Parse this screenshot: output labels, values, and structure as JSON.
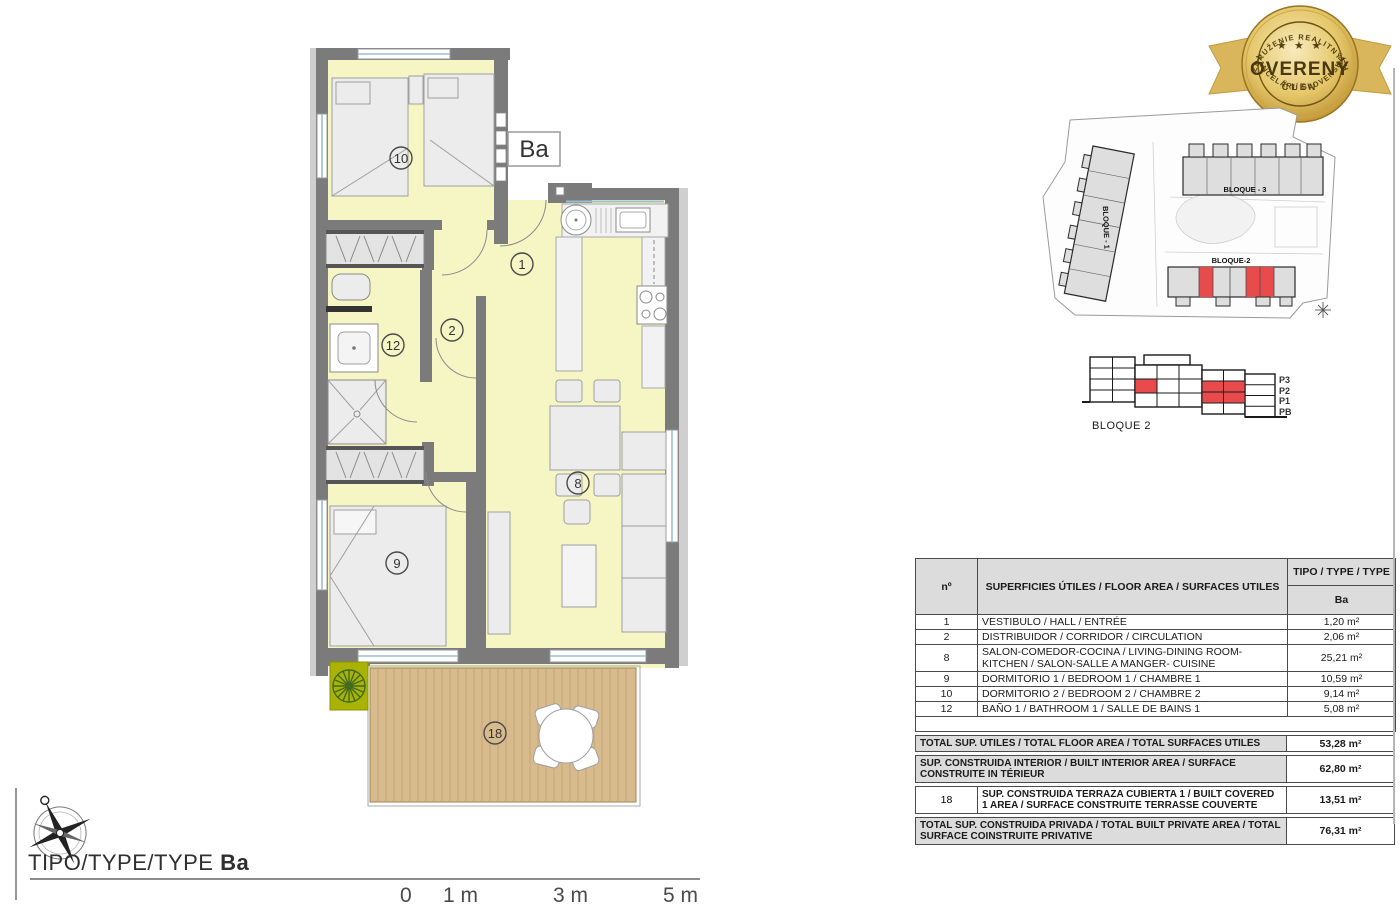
{
  "floor_plan": {
    "type_label": "Ba",
    "rooms": {
      "hall": "1",
      "corridor": "2",
      "living": "8",
      "bedroom1": "9",
      "bedroom2": "10",
      "bathroom": "12",
      "terrace": "18"
    }
  },
  "badge": {
    "arc_top": "ZDRUŽENIE REALITNÝCH",
    "stars": "★ ★ ★",
    "center": "OVERENÝ",
    "subtitle": "ČLEN",
    "arc_bottom": "KANCELÁRIÍ SLOVENSKA",
    "gold_color": "#c7992f"
  },
  "site_plan": {
    "bloque1_label": "BLOQUE - 1",
    "bloque2_label": "BLOQUE-2",
    "bloque3_label": "BLOQUE - 3",
    "highlight_color": "#e94b4d"
  },
  "elevation": {
    "title": "BLOQUE 2",
    "floors": [
      "P3",
      "P2",
      "P1",
      "PB"
    ],
    "highlight_color": "#e94b4d"
  },
  "areas_table": {
    "header": {
      "col_num": "nº",
      "col_desc": "SUPERFICIES ÚTILES / FLOOR AREA / SURFACES UTILES",
      "col_type": "TIPO / TYPE / TYPE",
      "type_value": "Ba"
    },
    "rows": [
      {
        "num": "1",
        "desc": "VESTIBULO / HALL / ENTRÉE",
        "area": "1,20 m²"
      },
      {
        "num": "2",
        "desc": "DISTRIBUIDOR / CORRIDOR / CIRCULATION",
        "area": "2,06 m²"
      },
      {
        "num": "8",
        "desc": "SALON-COMEDOR-COCINA / LIVING-DINING ROOM- KITCHEN / SALON-SALLE A MANGER- CUISINE",
        "area": "25,21 m²"
      },
      {
        "num": "9",
        "desc": "DORMITORIO 1 / BEDROOM 1 / CHAMBRE 1",
        "area": "10,59 m²"
      },
      {
        "num": "10",
        "desc": "DORMITORIO 2 / BEDROOM 2 / CHAMBRE 2",
        "area": "9,14 m²"
      },
      {
        "num": "12",
        "desc": "BAÑO 1 / BATHROOM 1 / SALLE DE BAINS 1",
        "area": "5,08 m²"
      }
    ],
    "summary": [
      {
        "num": "",
        "desc": "TOTAL SUP. UTILES / TOTAL FLOOR AREA / TOTAL SURFACES UTILES",
        "area": "53,28 m²"
      },
      {
        "num": "",
        "desc": "SUP. CONSTRUIDA INTERIOR / BUILT INTERIOR AREA / SURFACE CONSTRUITE IN TÉRIEUR",
        "area": "62,80 m²"
      },
      {
        "num": "18",
        "desc": "SUP. CONSTRUIDA TERRAZA CUBIERTA 1 / BUILT COVERED 1 AREA / SURFACE CONSTRUITE TERRASSE COUVERTE",
        "area": "13,51 m²"
      },
      {
        "num": "",
        "desc": "TOTAL SUP. CONSTRUIDA PRIVADA / TOTAL BUILT PRIVATE AREA / TOTAL SURFACE COINSTRUITE PRIVATIVE",
        "area": "76,31 m²"
      }
    ]
  },
  "footer": {
    "title_prefix": "TIPO/TYPE/TYPE ",
    "title_type": "Ba",
    "scale_ticks": [
      "0",
      "1 m",
      "3 m",
      "5 m"
    ]
  }
}
